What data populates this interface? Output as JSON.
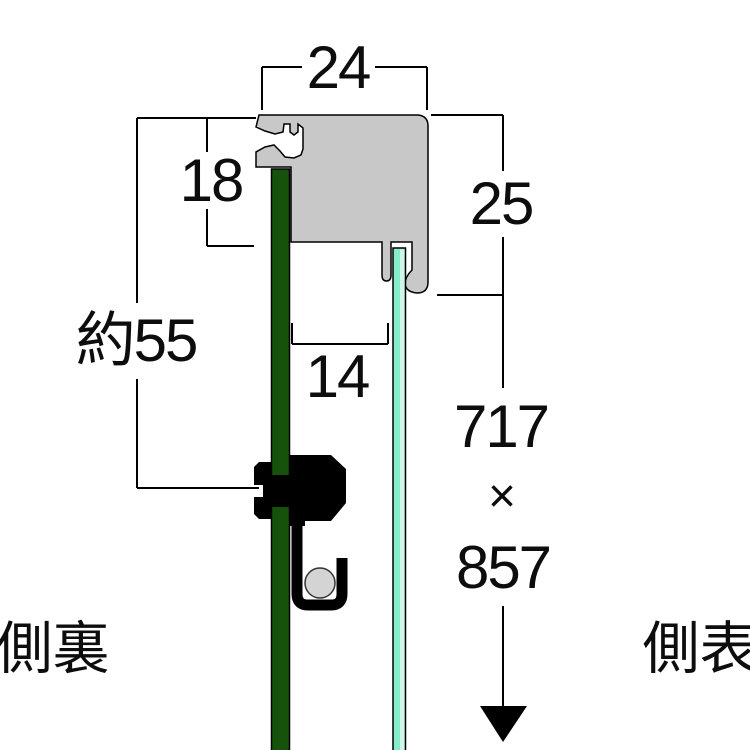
{
  "diagram": {
    "title_hint": "frame-profile-cross-section",
    "dimensions": {
      "top_width": "24",
      "back_depth": "18",
      "front_height": "25",
      "back_opening": "約55",
      "inner_width": "14",
      "artwork_width": "717",
      "times_sign": "×",
      "artwork_height": "857"
    },
    "labels": {
      "back_side": "裏側",
      "front_side": "表側"
    },
    "colors": {
      "frame_gray": "#c8c8c8",
      "backboard_green": "#16520b",
      "glass_mint": "#86ecc9",
      "glass_highlight": "#cdf8e9",
      "hardware_black": "#000000",
      "roller_gray": "#d4d4d4",
      "line_black": "#000000"
    },
    "icons": {
      "down_arrow": "filled-triangle-down"
    }
  }
}
